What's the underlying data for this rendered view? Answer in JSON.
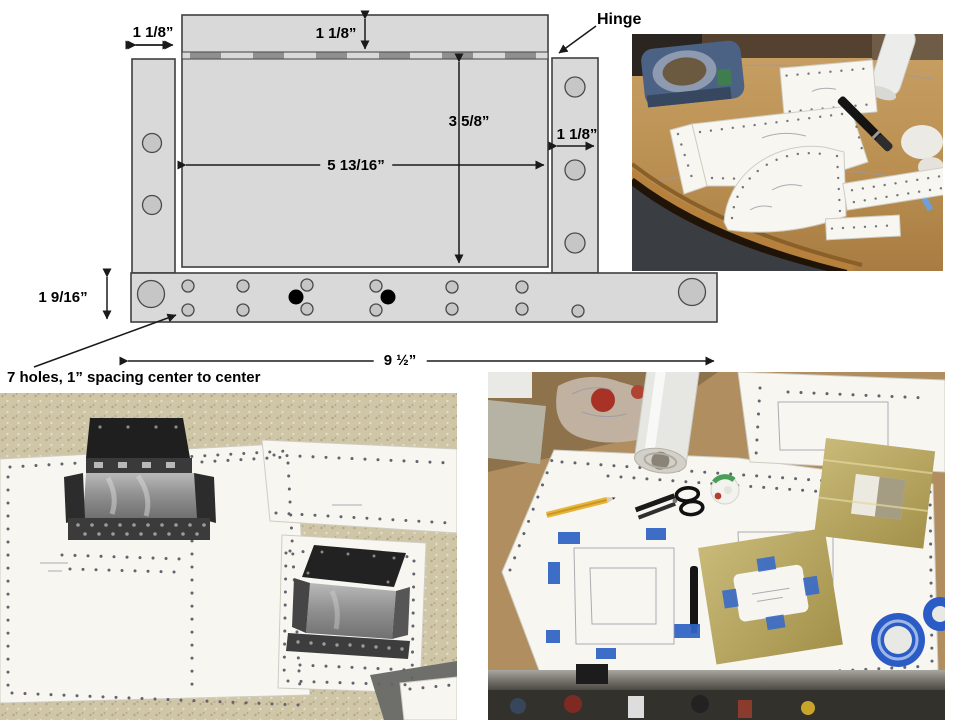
{
  "diagram": {
    "labels": {
      "dim_top_left": "1 1/8”",
      "dim_top_center": "1 1/8”",
      "hinge": "Hinge",
      "dim_plate_height": "3 5/8”",
      "dim_right_flange": "1 1/8”",
      "dim_plate_width": "5 13/16”",
      "dim_bottom_height": "1 9/16”",
      "dim_total_width": "9 ½”",
      "holes_note": "7 holes, 1” spacing center to center"
    },
    "colors": {
      "plate_fill": "#d9d9d9",
      "plate_stroke": "#3f3f3f",
      "hinge_dark": "#8f8f8f",
      "hole_fill": "#c6c6c6",
      "hole_stroke": "#4a4a4a",
      "filled_hole": "#000000",
      "arrow": "#1a1a1a"
    }
  }
}
